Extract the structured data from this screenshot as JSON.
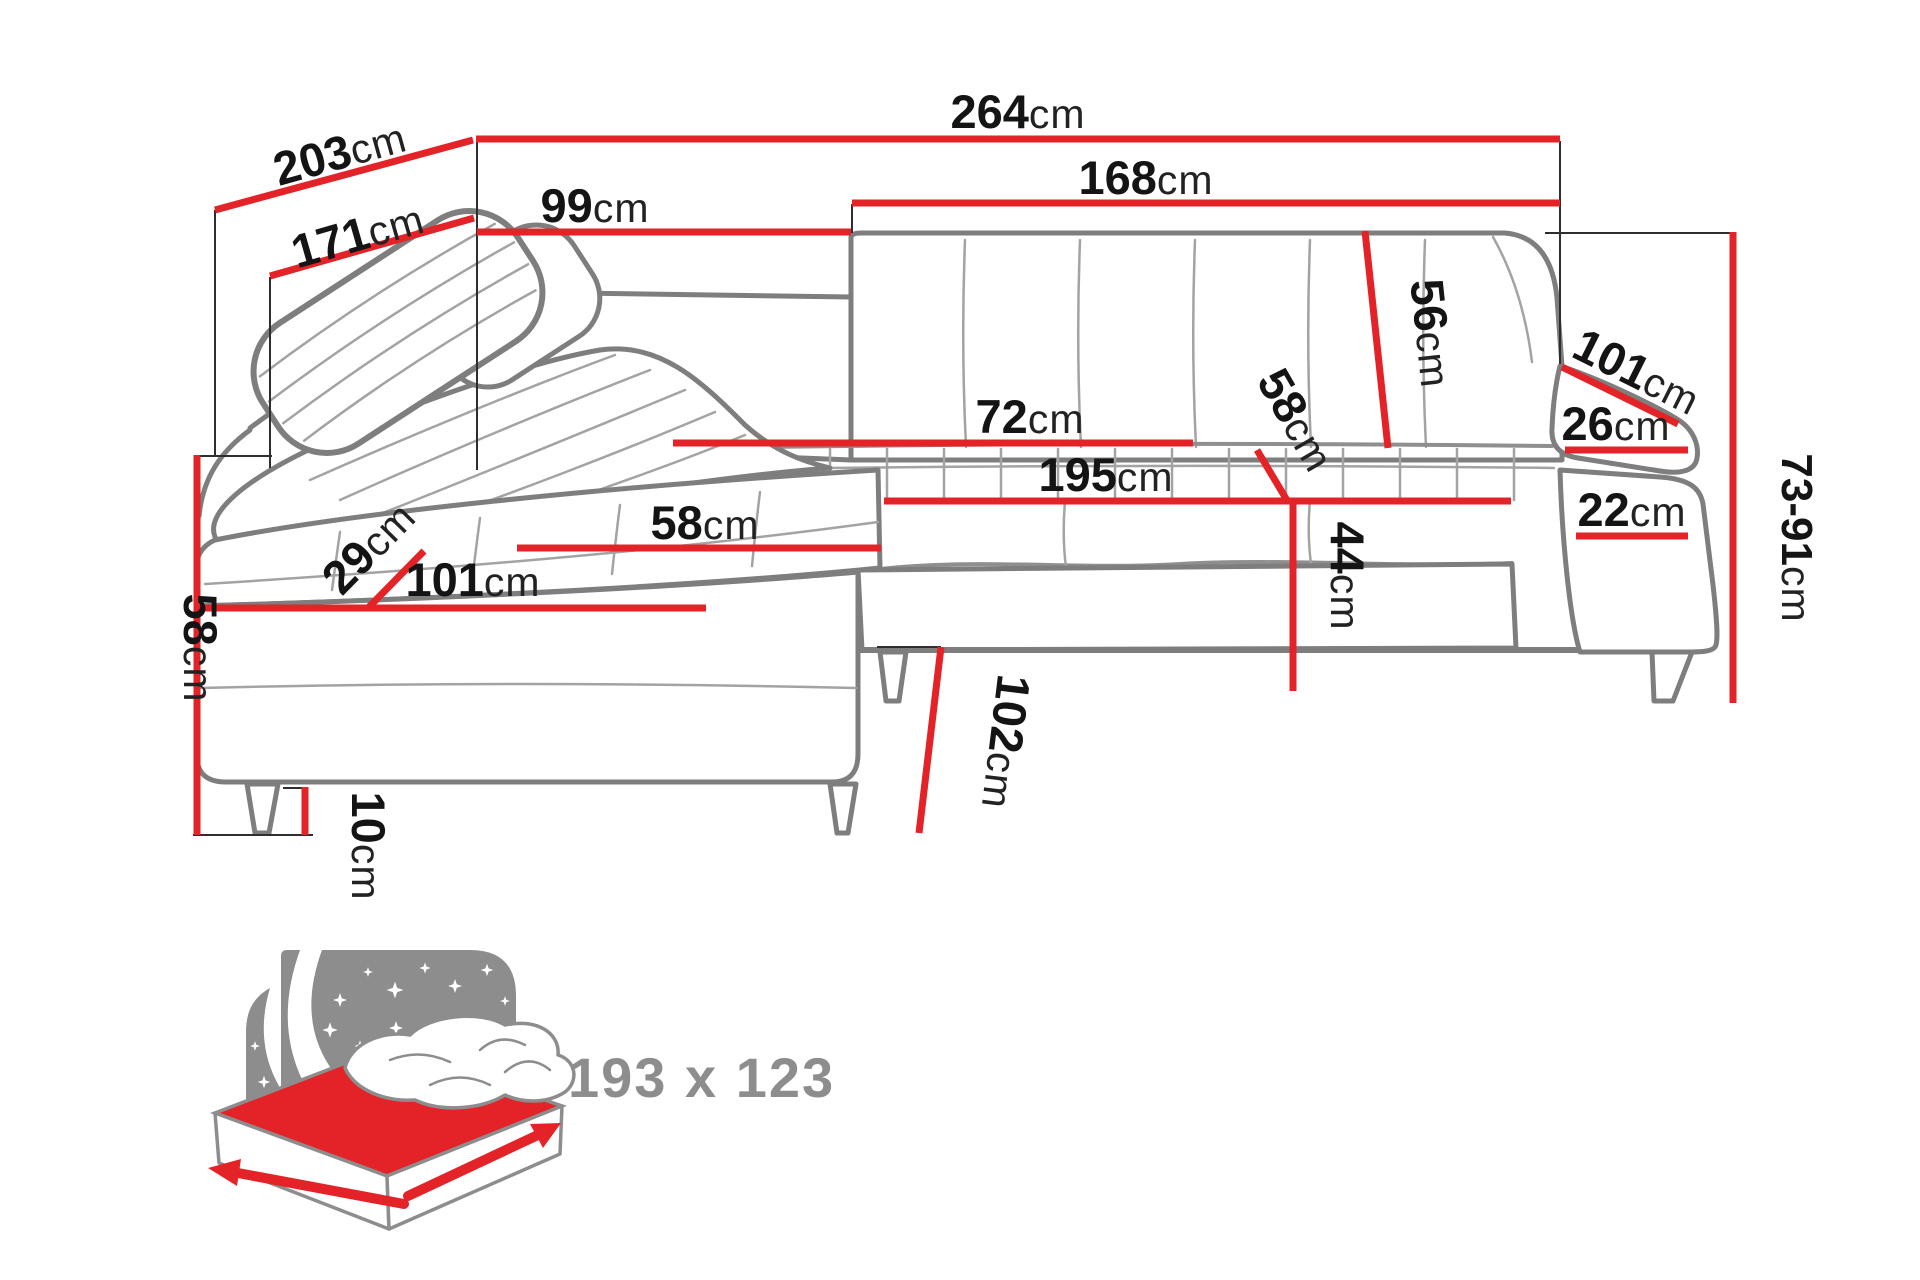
{
  "title": "Corner sofa bed dimensions diagram",
  "unit": "cm",
  "colors": {
    "dimension_red": "#e42328",
    "sofa_outline_gray": "#7e7e7e",
    "label_black": "#141414",
    "icon_gray": "#8d8d8d"
  },
  "dimensions": {
    "total_depth_left": {
      "value": "203",
      "unit": "cm"
    },
    "inner_depth_left": {
      "value": "171",
      "unit": "cm"
    },
    "total_width": {
      "value": "264",
      "unit": "cm"
    },
    "back_left_section": {
      "value": "99",
      "unit": "cm"
    },
    "back_right_section": {
      "value": "168",
      "unit": "cm"
    },
    "armrest_outer_len": {
      "value": "101",
      "unit": "cm"
    },
    "armrest_top_width": {
      "value": "26",
      "unit": "cm"
    },
    "armrest_base_width": {
      "value": "22",
      "unit": "cm"
    },
    "back_height_range": {
      "value": "73-91",
      "unit": "cm"
    },
    "backrest_height": {
      "value": "56",
      "unit": "cm"
    },
    "seatback_height": {
      "value": "58",
      "unit": "cm"
    },
    "seat_height": {
      "value": "44",
      "unit": "cm"
    },
    "seat_depth": {
      "value": "72",
      "unit": "cm"
    },
    "seat_width": {
      "value": "195",
      "unit": "cm"
    },
    "chaise_seat_width": {
      "value": "58",
      "unit": "cm"
    },
    "chaise_seat_length": {
      "value": "101",
      "unit": "cm"
    },
    "chaise_back_depth": {
      "value": "29",
      "unit": "cm"
    },
    "side_height": {
      "value": "58",
      "unit": "cm"
    },
    "leg_height": {
      "value": "10",
      "unit": "cm"
    },
    "chaise_total_depth": {
      "value": "102",
      "unit": "cm"
    }
  },
  "sleeping_area": {
    "label": "193 x 123"
  }
}
